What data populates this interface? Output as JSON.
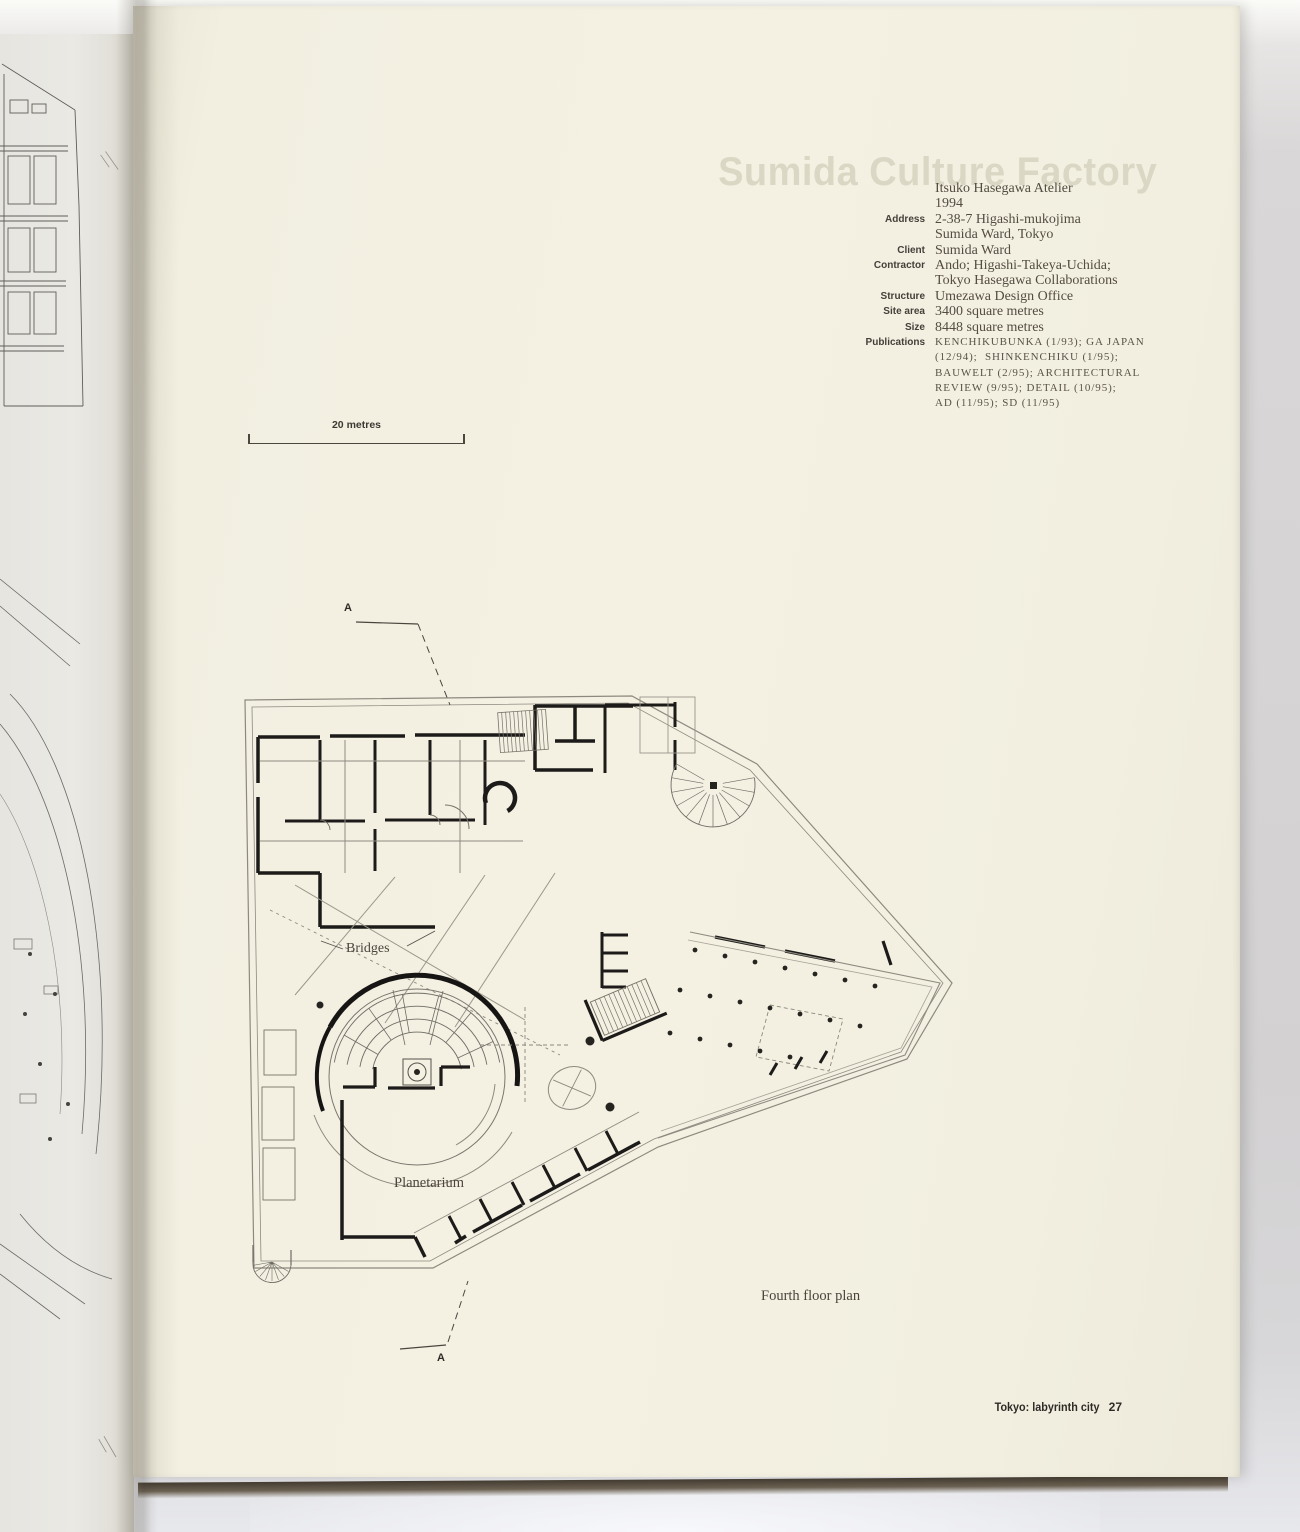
{
  "page": {
    "ghost_title": "Sumida Culture Factory",
    "details": {
      "rows": [
        {
          "label": "",
          "value": "Itsuko Hasegawa Atelier"
        },
        {
          "label": "",
          "value": "1994"
        },
        {
          "label": "Address",
          "value": "2-38-7 Higashi-mukojima"
        },
        {
          "label": "",
          "value": "Sumida Ward, Tokyo"
        },
        {
          "label": "Client",
          "value": "Sumida Ward"
        },
        {
          "label": "Contractor",
          "value": "Ando; Higashi-Takeya-Uchida;"
        },
        {
          "label": "",
          "value": "Tokyo Hasegawa Collaborations"
        },
        {
          "label": "Structure",
          "value": "Umezawa Design Office"
        },
        {
          "label": "Site area",
          "value": "3400 square metres"
        },
        {
          "label": "Size",
          "value": "8448 square metres"
        },
        {
          "label": "Publications",
          "value": "KENCHIKUBUNKA (1/93); GA JAPAN"
        },
        {
          "label": "",
          "value": "(12/94);  SHINKENCHIKU (1/95);"
        },
        {
          "label": "",
          "value": "BAUWELT (2/95); ARCHITECTURAL"
        },
        {
          "label": "",
          "value": "REVIEW (9/95); DETAIL (10/95);"
        },
        {
          "label": "",
          "value": "AD (11/95); SD (11/95)"
        }
      ]
    },
    "scale_bar": {
      "label": "20 metres"
    },
    "plan": {
      "labels": {
        "bridges": "Bridges",
        "planetarium": "Planetarium",
        "section_top": "A",
        "section_bottom": "A"
      },
      "caption": "Fourth floor plan"
    },
    "footer": {
      "running_head": "Tokyo: labyrinth city",
      "page_number": "27"
    },
    "colors": {
      "paper": "#f2efe1",
      "ink": "#1c1b19",
      "backdrop": "#d6d4d5"
    }
  }
}
